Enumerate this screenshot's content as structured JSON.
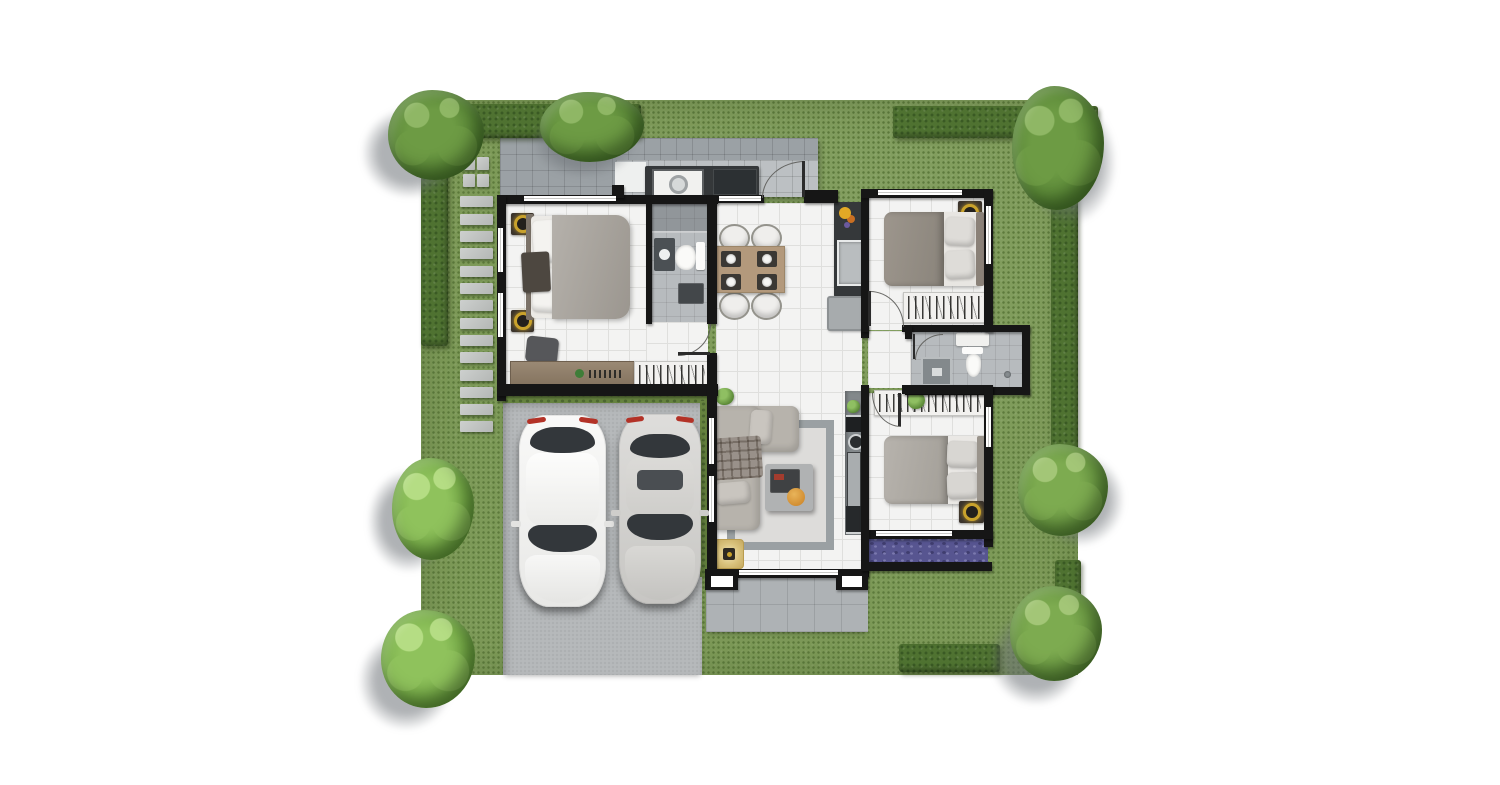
{
  "scene": {
    "type": "architectural-floor-plan-render",
    "view": "top-down",
    "canvas": {
      "width": 1500,
      "height": 785
    },
    "rooms": [
      {
        "name": "master-bedroom"
      },
      {
        "name": "bathroom-1"
      },
      {
        "name": "dining-area"
      },
      {
        "name": "kitchen"
      },
      {
        "name": "bedroom-2"
      },
      {
        "name": "bathroom-2"
      },
      {
        "name": "bedroom-3"
      },
      {
        "name": "living-room"
      },
      {
        "name": "terrace"
      },
      {
        "name": "laundry-back-patio"
      },
      {
        "name": "carport"
      }
    ],
    "vehicles": [
      "white-sedan",
      "silver-sedan"
    ]
  },
  "palette": {
    "grass": "#7d9a58",
    "grass-dot": "#5d7a3c",
    "hedge": "#4f7231",
    "hedge-dot": "#3a5a24",
    "slab": "#b6b9bb",
    "terrace": "#aeb2b5",
    "patio": "#9ba1a5",
    "patio-light": "#bcc0c3",
    "floor": "#f3f3f2",
    "floor-grid": "#dfdfdd",
    "bath": "#b7bbbe",
    "wall": "#161616",
    "wood": "#8d7c68",
    "table": "#b3997c",
    "duvet-master": "#a8a49e",
    "duvet-warm": "#938d85",
    "duvet-light": "#aeaaa4",
    "pillow": "#f4f3f0",
    "sofa": "#b7b3ac",
    "rug": "#dddcda",
    "rug-border": "#9aa0a3",
    "gold": "#c9a22c",
    "purple": "#575590",
    "purple-light": "#7b79ae",
    "purple-dark": "#3f3d6e",
    "orange": "#d8932f",
    "glass": "#33373b",
    "counter": "#35383a",
    "appliance": "#2c3033",
    "tree-d1": "#4e7b2f",
    "tree-d2": "#6d9b44",
    "tree-d3": "#8fb765",
    "tree-m1": "#5c8a38",
    "tree-m2": "#7dab50",
    "tree-m3": "#a3c677",
    "tree-b1": "#69a03c",
    "tree-b2": "#8fc25c",
    "tree-b3": "#b5dd84"
  },
  "garden": {
    "lawn": {
      "x": 421,
      "y": 100,
      "w": 657,
      "h": 575
    },
    "hedges": [
      {
        "x": 421,
        "y": 104,
        "w": 220,
        "h": 34
      },
      {
        "x": 421,
        "y": 134,
        "w": 27,
        "h": 212
      },
      {
        "x": 893,
        "y": 106,
        "w": 205,
        "h": 32
      },
      {
        "x": 1051,
        "y": 186,
        "w": 27,
        "h": 272
      },
      {
        "x": 1055,
        "y": 560,
        "w": 26,
        "h": 58
      },
      {
        "x": 899,
        "y": 644,
        "w": 101,
        "h": 28
      }
    ],
    "stepping_stones": {
      "pairs": [
        [
          463,
          157
        ],
        [
          477,
          157
        ],
        [
          463,
          174
        ],
        [
          477,
          174
        ]
      ],
      "pair_size": [
        12,
        13
      ],
      "column": {
        "x": 460,
        "w": 33,
        "h": 11,
        "ys": [
          196,
          214,
          231,
          248,
          266,
          283,
          300,
          318,
          335,
          352,
          370,
          387,
          404,
          421
        ]
      }
    },
    "trees": [
      {
        "x": 388,
        "y": 90,
        "w": 96,
        "h": 90,
        "variant": "dark",
        "sx": -26,
        "sy": 18
      },
      {
        "x": 540,
        "y": 92,
        "w": 104,
        "h": 70,
        "variant": "dark",
        "sx": -8,
        "sy": 16
      },
      {
        "x": 1012,
        "y": 86,
        "w": 92,
        "h": 124,
        "variant": "dark",
        "sx": 12,
        "sy": 14
      },
      {
        "x": 1018,
        "y": 444,
        "w": 90,
        "h": 92,
        "variant": "mid",
        "sx": 16,
        "sy": 10
      },
      {
        "x": 1010,
        "y": 586,
        "w": 92,
        "h": 95,
        "variant": "mid",
        "sx": -20,
        "sy": 24
      },
      {
        "x": 392,
        "y": 458,
        "w": 82,
        "h": 102,
        "variant": "bright",
        "sx": -24,
        "sy": 12
      },
      {
        "x": 381,
        "y": 610,
        "w": 94,
        "h": 98,
        "variant": "bright",
        "sx": -22,
        "sy": 22
      }
    ],
    "flower_bed": {
      "x": 862,
      "y": 536,
      "w": 126,
      "h": 30
    }
  }
}
